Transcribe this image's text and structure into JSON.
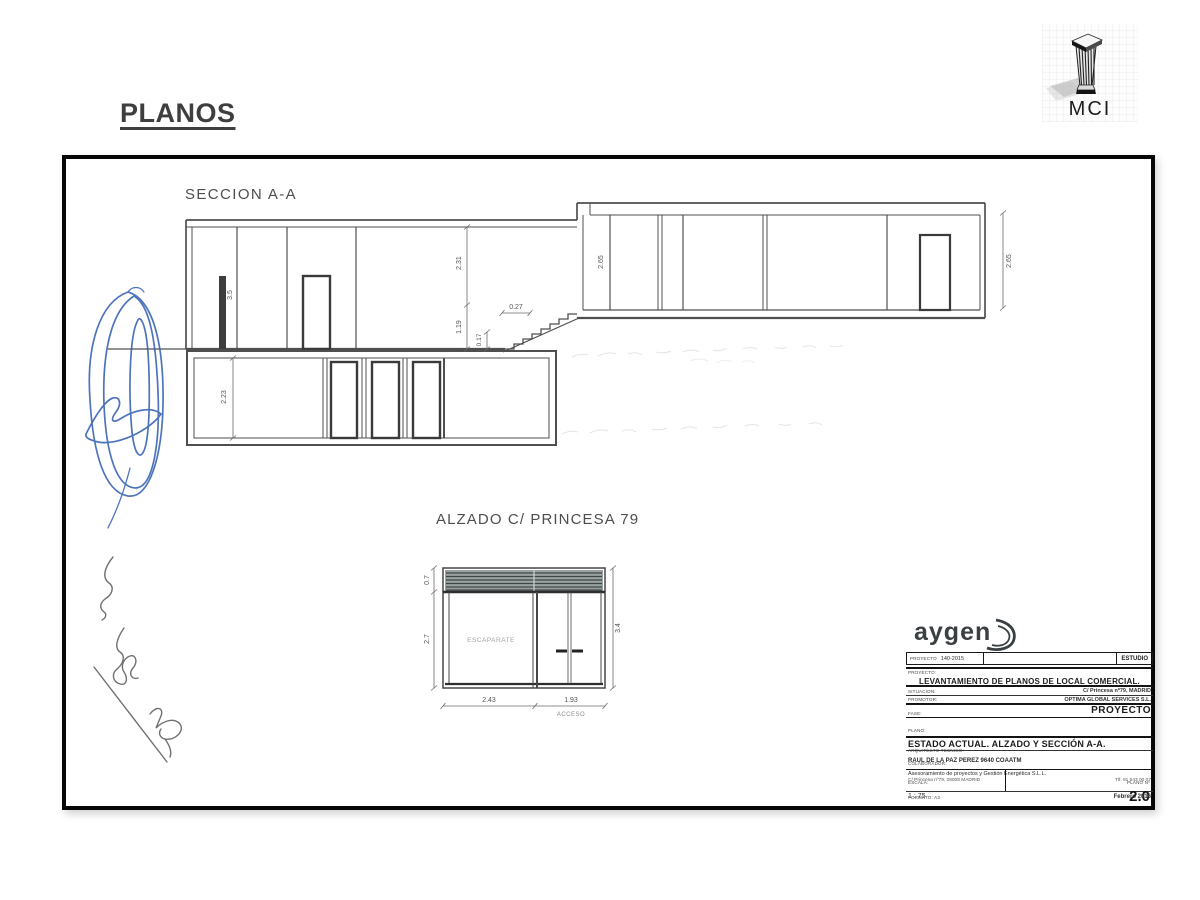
{
  "slide": {
    "title": "PLANOS"
  },
  "mci_logo": {
    "label": "MCI"
  },
  "seccion": {
    "title": "SECCION A-A",
    "dims": {
      "left_room_height": "3.5",
      "upper_height": "2.31",
      "lower_height": "1.19",
      "step_riser": "0.17",
      "step_tread": "0.27",
      "right_room_height_inner": "2.65",
      "right_room_height_outer": "2.65",
      "basement_height": "2.23"
    }
  },
  "alzado": {
    "title": "ALZADO C/ PRINCESA 79",
    "escaparate": "ESCAPARATE",
    "acceso": "ACCESO",
    "dims": {
      "persiana_height": "0.7",
      "escaparate_height": "2.7",
      "total_height": "3.4",
      "escaparate_width": "2.43",
      "puerta_width": "1.93"
    }
  },
  "title_block": {
    "brand": "aygen",
    "proyecto_num_label": "PROYECTO",
    "proyecto_num_value": "140-2015",
    "estudio_label": "ESTUDIO",
    "proyecto_label": "PROYECTO:",
    "proyecto_titulo": "LEVANTAMIENTO DE PLANOS DE LOCAL COMERCIAL.",
    "situacion_label": "SITUACION:",
    "situacion_value": "C/ Princesa nº79,  MADRID",
    "promotor_label": "PROMOTOR:",
    "promotor_value": "OPTIMA GLOBAL SERVICES S.L.",
    "fase_label": "FASE:",
    "fase_value": "PROYECTO",
    "plano_label": "PLANO:",
    "plano_titulo": "ESTADO ACTUAL. ALZADO Y SECCIÓN A-A.",
    "tecnico_label": "ARQUITECTO TECNICO:",
    "tecnico_value": "RAUL DE LA PAZ PEREZ    9640 COAATM",
    "colaborador_label": "COLABORADOR:",
    "colaborador_value": "Asesoramiento de proyectos y Gestión Energética S.L.L.",
    "colaborador_direccion": "C/ Princesa nº79, 28008 MADRID",
    "colaborador_contacto": "Tlf. 91 543 00 07",
    "escala_label": "ESCALA:",
    "escala_value": "1 : 75",
    "plano_num_label": "PLANO Nº",
    "plano_num_value": "2.0",
    "fecha_value": "Febrero 2016",
    "formato_label": "FORMATO:  A3"
  }
}
